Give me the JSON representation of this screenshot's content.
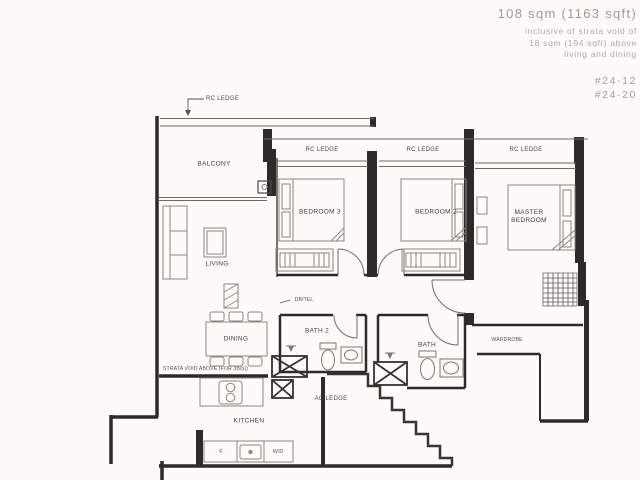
{
  "header": {
    "area": "108 sqm (1163 sqft)",
    "note_line1": "inclusive of strata void of",
    "note_line2": "18 sqm (194 sqft) above",
    "note_line3": "living and dining",
    "unit_line1": "#24-12",
    "unit_line2": "#24-20"
  },
  "rooms": {
    "balcony": "BALCONY",
    "living": "LIVING",
    "dining": "DINING",
    "bedroom3": "BEDROOM 3",
    "bedroom2": "BEDROOM 2",
    "master_line1": "MASTER",
    "master_line2": "BEDROOM",
    "bath2": "BATH 2",
    "bath": "BATH",
    "kitchen": "KITCHEN",
    "wardrobe": "WARDROBE"
  },
  "annotations": {
    "rc_ledge_balcony": "RC LEDGE",
    "rc_ledge_bed3": "RC LEDGE",
    "rc_ledge_bed2": "RC LEDGE",
    "rc_ledge_master": "RC LEDGE",
    "ac_ledge": "AC LEDGE",
    "db": "DB/TEL",
    "strata_note": "STRATA VOID ABOVE (FOR 3B(s))"
  },
  "appliances": {
    "fridge": "F",
    "washer_dryer": "W/D"
  },
  "colors": {
    "background": "#fcfbf8",
    "wall": "#2c2b27",
    "thin_line": "#6e6b64",
    "furniture_line": "#8b8780",
    "label_text": "#3f3d38",
    "header_text": "#a4a19a"
  }
}
